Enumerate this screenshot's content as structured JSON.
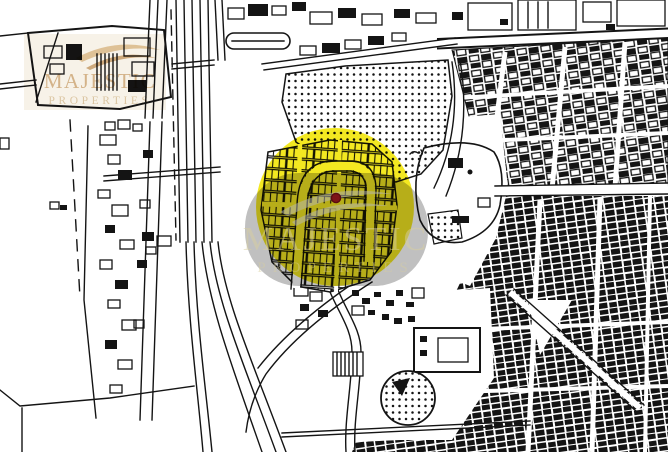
{
  "colors": {
    "background": "#ffffff",
    "map_line": "#141414",
    "highlight_yellow": "#f2e60e",
    "marker_red": "#7d1518",
    "marker_ring": "#5a0d10",
    "watermark_gray": "#929292",
    "watermark_gray_swoosh": "#b8b8b8",
    "center_text": "#d8cfa0",
    "logo_bg": "#f0e6d2",
    "logo_swoosh_light": "#dcbd8e",
    "logo_swoosh_dark": "#c9a271",
    "logo_text": "#d2b084",
    "logo_tagline": "#d8c09a"
  },
  "watermarks": {
    "top_left": {
      "name": "MAJESTIC",
      "tagline": "PROPERTIES"
    },
    "center": {
      "name": "MAJESTIC",
      "tagline": "PROPERTIES"
    }
  }
}
